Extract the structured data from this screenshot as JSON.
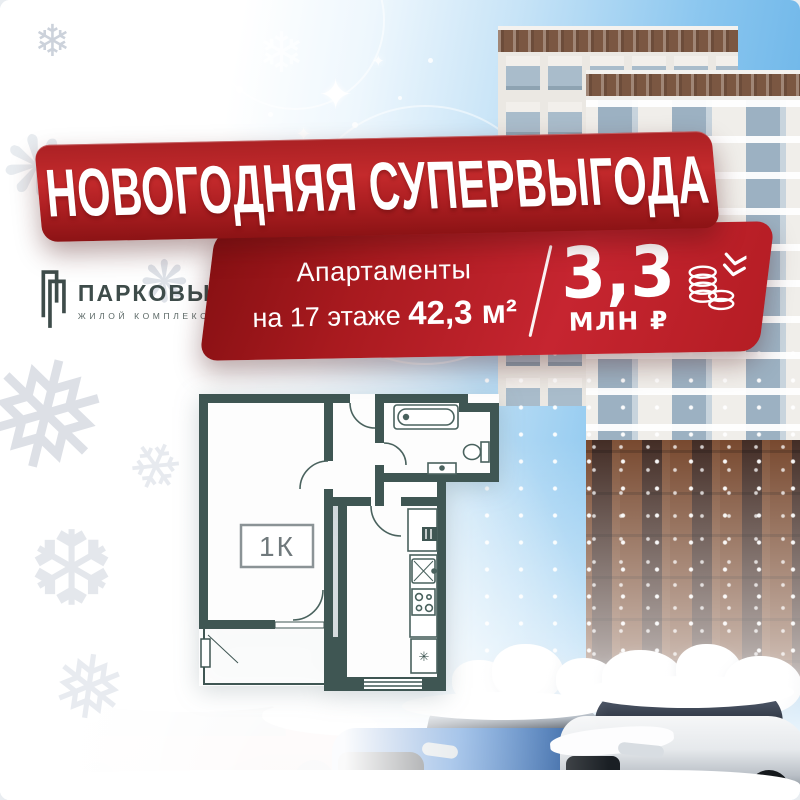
{
  "banner": {
    "title": "НОВОГОДНЯЯ СУПЕРВЫГОДА"
  },
  "logo": {
    "name": "ПАРКОВЫЙ",
    "subtitle": "ЖИЛОЙ КОМПЛЕКС",
    "icon": "double-bracket-logo-icon"
  },
  "offer": {
    "line1": "Апартаменты",
    "line2": "на 17 этаже",
    "area": "42,3 м²",
    "price": "3,3",
    "price_unit": "МЛН ₽",
    "price_icon": "coins-price-drop-icon"
  },
  "floor_plan": {
    "room_label": "1К",
    "fridge_symbol": "✳"
  },
  "glyphs": {
    "snowflake": "❄",
    "snowflake_heavy": "❅",
    "snowflake_chevron": "❆",
    "sparkle": "✦",
    "burst": "❋"
  },
  "colors": {
    "banner_red": "#c42a2c",
    "banner_red_dark": "#8c1315",
    "card_red": "#c62530",
    "wall_teal": "#3f5653",
    "logo_teal": "#3e4c4a",
    "sky_blue": "#56a9e4",
    "brick_brown": "#78492f"
  }
}
